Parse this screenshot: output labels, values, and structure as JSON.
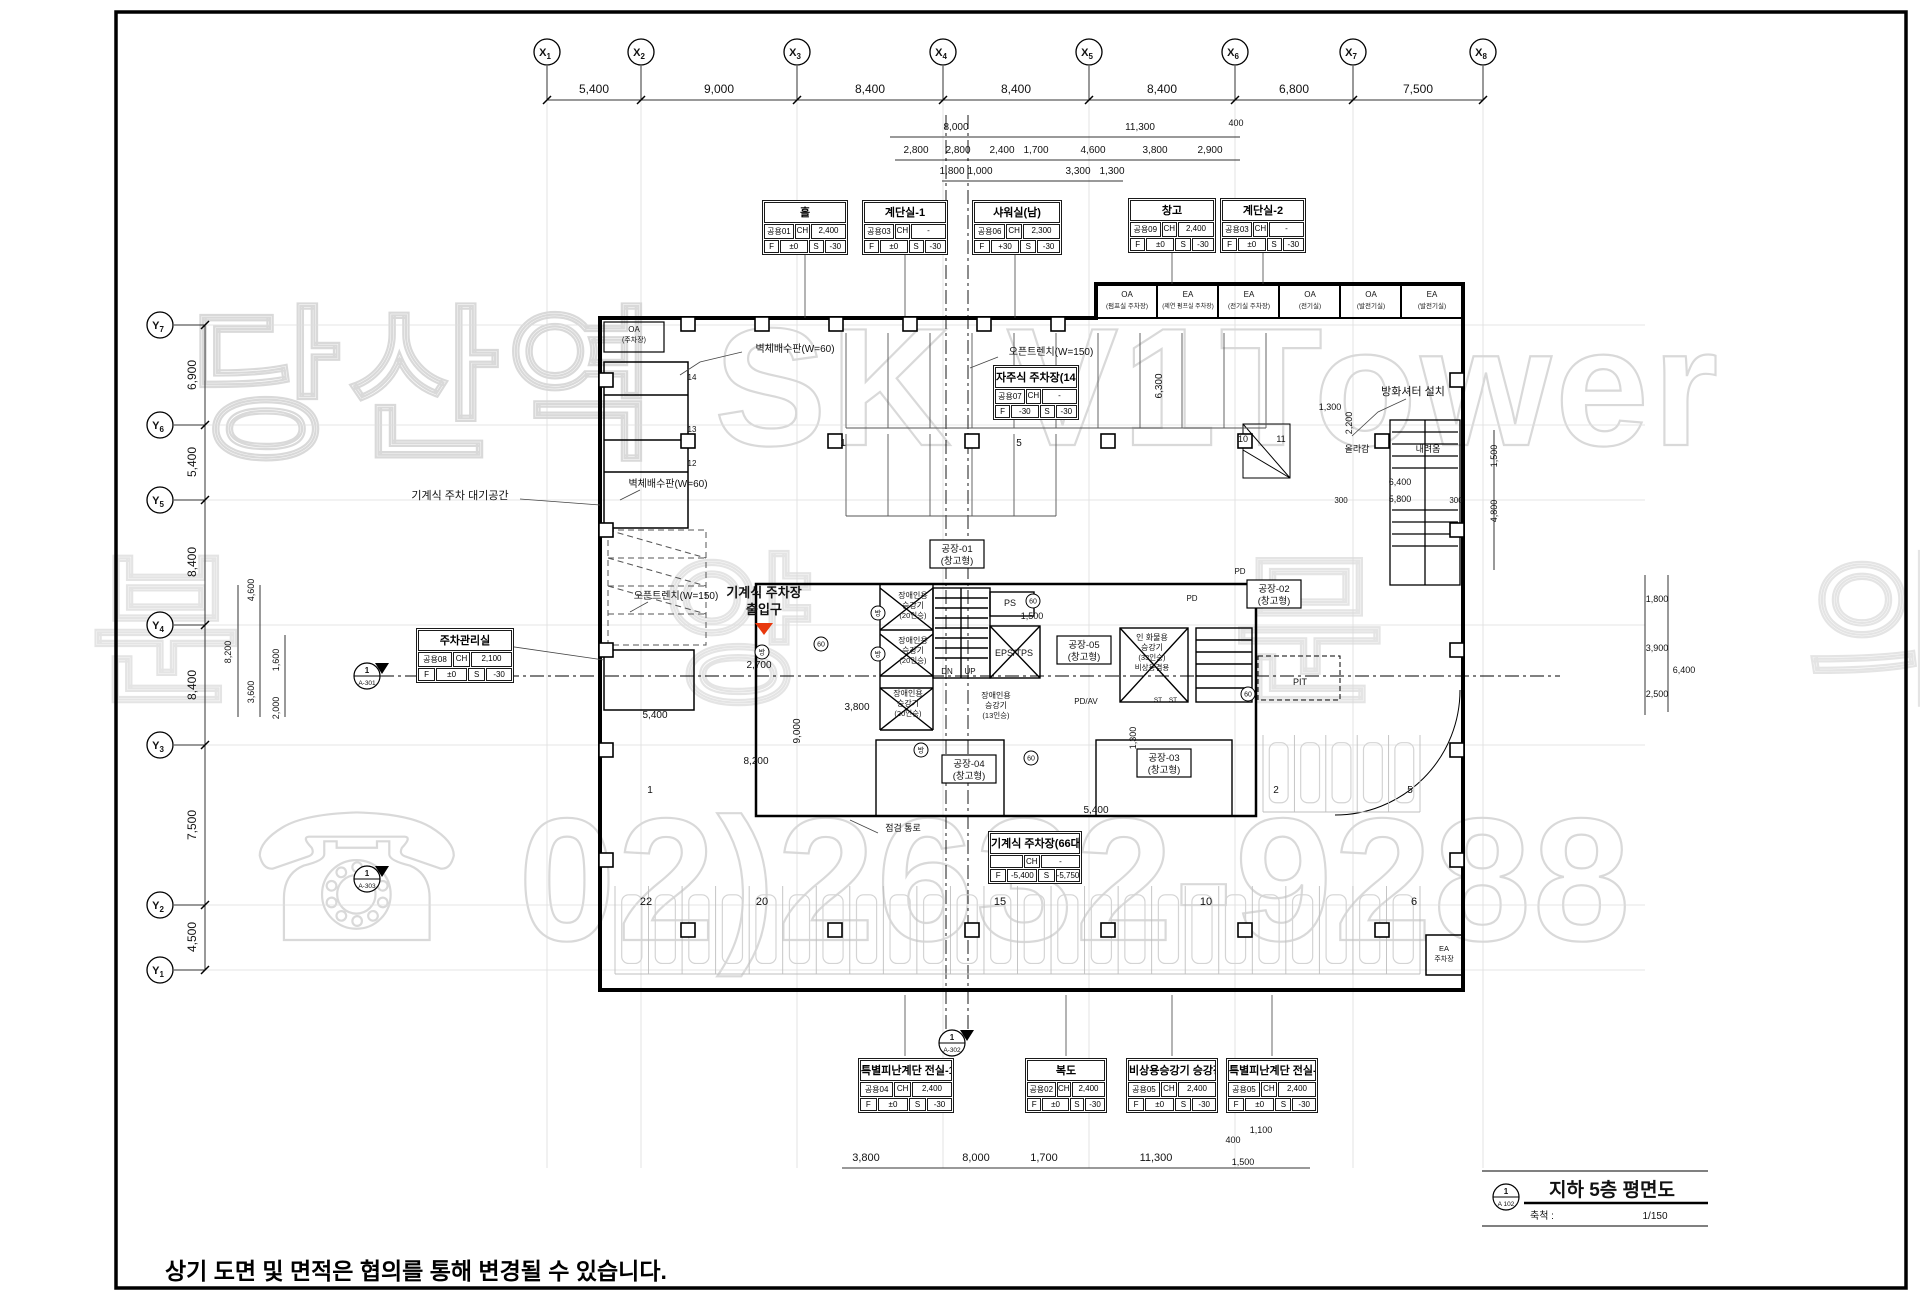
{
  "watermark": {
    "line1": "당산역 SK V1Tower",
    "line2": "분양문의",
    "line3": "☎ 02)2632-9288"
  },
  "footer_note": "상기 도면 및 면적은 협의를 통해 변경될 수 있습니다.",
  "title_block": {
    "num": "1",
    "sheet": "A 102",
    "title": "지하 5층 평면도",
    "scale_label": "축척 :",
    "scale": "1/150"
  },
  "red_label": {
    "line1": "기계식 주차장",
    "line2": "출입구"
  },
  "grid": {
    "x_markers": [
      {
        "t": "X1",
        "x": 547
      },
      {
        "t": "X2",
        "x": 641
      },
      {
        "t": "X3",
        "x": 797
      },
      {
        "t": "X4",
        "x": 943
      },
      {
        "t": "X5",
        "x": 1089
      },
      {
        "t": "X6",
        "x": 1235
      },
      {
        "t": "X7",
        "x": 1353
      },
      {
        "t": "X8",
        "x": 1483
      }
    ],
    "y_markers": [
      {
        "t": "Y7",
        "y": 325
      },
      {
        "t": "Y6",
        "y": 425
      },
      {
        "t": "Y5",
        "y": 500
      },
      {
        "t": "Y4",
        "y": 625
      },
      {
        "t": "Y3",
        "y": 745
      },
      {
        "t": "Y2",
        "y": 905
      },
      {
        "t": "Y1",
        "y": 970
      }
    ]
  },
  "room_tables": [
    {
      "x": 762,
      "y": 200,
      "w": 86,
      "label": "홀",
      "code": "공용01",
      "ch": "CH",
      "chv": "2,400",
      "f": "F",
      "fv": "±0",
      "s": "S",
      "sv": "-30"
    },
    {
      "x": 862,
      "y": 200,
      "w": 86,
      "label": "계단실-1",
      "code": "공용03",
      "ch": "CH",
      "chv": "-",
      "f": "F",
      "fv": "±0",
      "s": "S",
      "sv": "-30"
    },
    {
      "x": 972,
      "y": 200,
      "w": 90,
      "label": "샤워실(남)",
      "code": "공용06",
      "ch": "CH",
      "chv": "2,300",
      "f": "F",
      "fv": "+30",
      "s": "S",
      "sv": "-30"
    },
    {
      "x": 1128,
      "y": 198,
      "w": 88,
      "label": "창고",
      "code": "공용09",
      "ch": "CH",
      "chv": "2,400",
      "f": "F",
      "fv": "±0",
      "s": "S",
      "sv": "-30"
    },
    {
      "x": 1220,
      "y": 198,
      "w": 86,
      "label": "계단실-2",
      "code": "공용03",
      "ch": "CH",
      "chv": "-",
      "f": "F",
      "fv": "±0",
      "s": "S",
      "sv": "-30"
    },
    {
      "x": 993,
      "y": 365,
      "w": 86,
      "label": "자주식 주차장(14대)",
      "code": "공용07",
      "ch": "CH",
      "chv": "-",
      "f": "F",
      "fv": "-30",
      "s": "S",
      "sv": "-30"
    },
    {
      "x": 416,
      "y": 628,
      "w": 98,
      "label": "주차관리실",
      "code": "공용08",
      "ch": "CH",
      "chv": "2,100",
      "f": "F",
      "fv": "±0",
      "s": "S",
      "sv": "-30"
    },
    {
      "x": 988,
      "y": 831,
      "w": 94,
      "label": "기계식 주차장(66대)",
      "code": "",
      "ch": "CH",
      "chv": "-",
      "f": "F",
      "fv": "-5,400",
      "s": "S",
      "sv": "-5,750"
    },
    {
      "x": 858,
      "y": 1058,
      "w": 96,
      "label": "특별피난계단 전실-1",
      "code": "공용04",
      "ch": "CH",
      "chv": "2,400",
      "f": "F",
      "fv": "±0",
      "s": "S",
      "sv": "-30"
    },
    {
      "x": 1025,
      "y": 1058,
      "w": 82,
      "label": "복도",
      "code": "공용02",
      "ch": "CH",
      "chv": "2,400",
      "f": "F",
      "fv": "±0",
      "s": "S",
      "sv": "-30"
    },
    {
      "x": 1126,
      "y": 1058,
      "w": 92,
      "label": "비상용승강기 승강장",
      "code": "공용05",
      "ch": "CH",
      "chv": "2,400",
      "f": "F",
      "fv": "±0",
      "s": "S",
      "sv": "-30"
    },
    {
      "x": 1226,
      "y": 1058,
      "w": 92,
      "label": "특별피난계단 전실-2",
      "code": "공용05",
      "ch": "CH",
      "chv": "2,400",
      "f": "F",
      "fv": "±0",
      "s": "S",
      "sv": "-30"
    }
  ],
  "annotations": [
    {
      "t": "5,400",
      "x": 594,
      "y": 93,
      "s": 12
    },
    {
      "t": "9,000",
      "x": 719,
      "y": 93,
      "s": 12
    },
    {
      "t": "8,400",
      "x": 870,
      "y": 93,
      "s": 12
    },
    {
      "t": "8,400",
      "x": 1016,
      "y": 93,
      "s": 12
    },
    {
      "t": "8,400",
      "x": 1162,
      "y": 93,
      "s": 12
    },
    {
      "t": "6,800",
      "x": 1294,
      "y": 93,
      "s": 12
    },
    {
      "t": "7,500",
      "x": 1418,
      "y": 93,
      "s": 12
    },
    {
      "t": "8,000",
      "x": 956,
      "y": 130,
      "s": 10
    },
    {
      "t": "11,300",
      "x": 1140,
      "y": 130,
      "s": 10
    },
    {
      "t": "400",
      "x": 1236,
      "y": 126,
      "s": 9
    },
    {
      "t": "2,800",
      "x": 916,
      "y": 153,
      "s": 10
    },
    {
      "t": "2,800",
      "x": 958,
      "y": 153,
      "s": 10
    },
    {
      "t": "2,400",
      "x": 1002,
      "y": 153,
      "s": 10
    },
    {
      "t": "1,700",
      "x": 1036,
      "y": 153,
      "s": 10
    },
    {
      "t": "4,600",
      "x": 1093,
      "y": 153,
      "s": 10
    },
    {
      "t": "3,800",
      "x": 1155,
      "y": 153,
      "s": 10
    },
    {
      "t": "2,900",
      "x": 1210,
      "y": 153,
      "s": 10
    },
    {
      "t": "1,800",
      "x": 952,
      "y": 174,
      "s": 10
    },
    {
      "t": "1,000",
      "x": 980,
      "y": 174,
      "s": 10
    },
    {
      "t": "3,300",
      "x": 1078,
      "y": 174,
      "s": 10
    },
    {
      "t": "1,300",
      "x": 1112,
      "y": 174,
      "s": 10
    },
    {
      "t": "6,900",
      "x": 196,
      "y": 375,
      "s": 12,
      "r": 1
    },
    {
      "t": "5,400",
      "x": 196,
      "y": 462,
      "s": 12,
      "r": 1
    },
    {
      "t": "8,400",
      "x": 196,
      "y": 562,
      "s": 12,
      "r": 1
    },
    {
      "t": "8,400",
      "x": 196,
      "y": 685,
      "s": 12,
      "r": 1
    },
    {
      "t": "7,500",
      "x": 196,
      "y": 825,
      "s": 12,
      "r": 1
    },
    {
      "t": "4,500",
      "x": 196,
      "y": 937,
      "s": 12,
      "r": 1
    },
    {
      "t": "8,200",
      "x": 231,
      "y": 652,
      "s": 9,
      "r": 1
    },
    {
      "t": "4,600",
      "x": 254,
      "y": 590,
      "s": 9,
      "r": 1
    },
    {
      "t": "3,600",
      "x": 254,
      "y": 692,
      "s": 9,
      "r": 1
    },
    {
      "t": "1,600",
      "x": 279,
      "y": 660,
      "s": 9,
      "r": 1
    },
    {
      "t": "2,000",
      "x": 279,
      "y": 708,
      "s": 9,
      "r": 1
    },
    {
      "t": "1,800",
      "x": 1657,
      "y": 602,
      "s": 9
    },
    {
      "t": "3,900",
      "x": 1657,
      "y": 651,
      "s": 9
    },
    {
      "t": "6,400",
      "x": 1684,
      "y": 673,
      "s": 9
    },
    {
      "t": "2,500",
      "x": 1657,
      "y": 697,
      "s": 9
    },
    {
      "t": "1,500",
      "x": 1497,
      "y": 456,
      "s": 9,
      "r": 1
    },
    {
      "t": "4,800",
      "x": 1497,
      "y": 511,
      "s": 9,
      "r": 1
    },
    {
      "t": "1,300",
      "x": 1330,
      "y": 410,
      "s": 9
    },
    {
      "t": "2,200",
      "x": 1352,
      "y": 423,
      "s": 9,
      "r": 1
    },
    {
      "t": "올라감",
      "x": 1357,
      "y": 452,
      "s": 9
    },
    {
      "t": "내려옴",
      "x": 1428,
      "y": 452,
      "s": 9
    },
    {
      "t": "6,400",
      "x": 1400,
      "y": 485,
      "s": 9
    },
    {
      "t": "5,800",
      "x": 1400,
      "y": 502,
      "s": 9
    },
    {
      "t": "300",
      "x": 1341,
      "y": 503,
      "s": 8
    },
    {
      "t": "300",
      "x": 1456,
      "y": 503,
      "s": 8
    },
    {
      "t": "6,300",
      "x": 1162,
      "y": 386,
      "s": 10,
      "r": 1
    },
    {
      "t": "2,700",
      "x": 759,
      "y": 668,
      "s": 10
    },
    {
      "t": "3,800",
      "x": 857,
      "y": 710,
      "s": 10
    },
    {
      "t": "5,400",
      "x": 655,
      "y": 718,
      "s": 10
    },
    {
      "t": "8,200",
      "x": 756,
      "y": 764,
      "s": 10
    },
    {
      "t": "9,000",
      "x": 800,
      "y": 731,
      "s": 10,
      "r": 1
    },
    {
      "t": "5,400",
      "x": 1096,
      "y": 813,
      "s": 10
    },
    {
      "t": "1,300",
      "x": 1136,
      "y": 738,
      "s": 9,
      "r": 1
    },
    {
      "t": "1,500",
      "x": 1032,
      "y": 619,
      "s": 9
    },
    {
      "t": "3,800",
      "x": 866,
      "y": 1161,
      "s": 11
    },
    {
      "t": "8,000",
      "x": 976,
      "y": 1161,
      "s": 11
    },
    {
      "t": "1,700",
      "x": 1044,
      "y": 1161,
      "s": 11
    },
    {
      "t": "11,300",
      "x": 1156,
      "y": 1161,
      "s": 11
    },
    {
      "t": "400",
      "x": 1233,
      "y": 1143,
      "s": 9
    },
    {
      "t": "1,100",
      "x": 1261,
      "y": 1133,
      "s": 9
    },
    {
      "t": "1,500",
      "x": 1243,
      "y": 1165,
      "s": 9
    },
    {
      "t": "기계식 주차 대기공간",
      "x": 460,
      "y": 499,
      "s": 11,
      "n": "waiting-area-label"
    },
    {
      "t": "벽체배수판(W=60)",
      "x": 795,
      "y": 352,
      "s": 10,
      "n": "wall-drain-label"
    },
    {
      "t": "벽체배수판(W=60)",
      "x": 668,
      "y": 487,
      "s": 10,
      "n": "wall-drain-label"
    },
    {
      "t": "오픈트렌치(W=150)",
      "x": 1051,
      "y": 355,
      "s": 10,
      "n": "open-trench-label"
    },
    {
      "t": "오픈트렌치(W=150)",
      "x": 676,
      "y": 599,
      "s": 10,
      "n": "open-trench-label"
    },
    {
      "t": "방화셔터 설치",
      "x": 1413,
      "y": 395,
      "s": 11,
      "n": "fire-shutter-label"
    },
    {
      "t": "점검 통로",
      "x": 903,
      "y": 831,
      "s": 9,
      "n": "inspection-path-label"
    },
    {
      "t": "OA",
      "x": 634,
      "y": 332,
      "s": 8
    },
    {
      "t": "(주차장)",
      "x": 634,
      "y": 342,
      "s": 7
    },
    {
      "t": "OA",
      "x": 1127,
      "y": 297,
      "s": 8
    },
    {
      "t": "(펌프실 주차장)",
      "x": 1127,
      "y": 308,
      "s": 6.5
    },
    {
      "t": "EA",
      "x": 1188,
      "y": 297,
      "s": 8
    },
    {
      "t": "(제연 펌프실 주차장)",
      "x": 1188,
      "y": 308,
      "s": 6
    },
    {
      "t": "EA",
      "x": 1249,
      "y": 297,
      "s": 8
    },
    {
      "t": "(전기실 주차장)",
      "x": 1249,
      "y": 308,
      "s": 6.5
    },
    {
      "t": "OA",
      "x": 1310,
      "y": 297,
      "s": 8
    },
    {
      "t": "(전기실)",
      "x": 1310,
      "y": 308,
      "s": 6.5
    },
    {
      "t": "OA",
      "x": 1371,
      "y": 297,
      "s": 8
    },
    {
      "t": "(발전기실)",
      "x": 1371,
      "y": 308,
      "s": 6.5
    },
    {
      "t": "EA",
      "x": 1432,
      "y": 297,
      "s": 8
    },
    {
      "t": "(발전기실)",
      "x": 1432,
      "y": 308,
      "s": 6.5
    },
    {
      "t": "EA",
      "x": 1444,
      "y": 951,
      "s": 7.5
    },
    {
      "t": "주차장",
      "x": 1444,
      "y": 961,
      "s": 7
    },
    {
      "t": "장애인용",
      "x": 913,
      "y": 598,
      "s": 8
    },
    {
      "t": "승강기",
      "x": 913,
      "y": 608,
      "s": 8
    },
    {
      "t": "(20인승)",
      "x": 913,
      "y": 618,
      "s": 7.5
    },
    {
      "t": "장애인용",
      "x": 913,
      "y": 643,
      "s": 8
    },
    {
      "t": "승강기",
      "x": 913,
      "y": 653,
      "s": 8
    },
    {
      "t": "(20인승)",
      "x": 913,
      "y": 663,
      "s": 7.5
    },
    {
      "t": "장애인용",
      "x": 908,
      "y": 696,
      "s": 8
    },
    {
      "t": "승강기",
      "x": 908,
      "y": 706,
      "s": 8
    },
    {
      "t": "(20인승)",
      "x": 908,
      "y": 716,
      "s": 7.5
    },
    {
      "t": "장애인용",
      "x": 996,
      "y": 698,
      "s": 8
    },
    {
      "t": "승강기",
      "x": 996,
      "y": 708,
      "s": 8
    },
    {
      "t": "(13인승)",
      "x": 996,
      "y": 718,
      "s": 7.5
    },
    {
      "t": "PS",
      "x": 1010,
      "y": 606,
      "s": 9
    },
    {
      "t": "EPS/TPS",
      "x": 1014,
      "y": 656,
      "s": 9
    },
    {
      "t": "DN",
      "x": 947,
      "y": 674,
      "s": 8
    },
    {
      "t": "UP",
      "x": 970,
      "y": 674,
      "s": 8
    },
    {
      "t": "PD",
      "x": 1192,
      "y": 601,
      "s": 8
    },
    {
      "t": "PD",
      "x": 1248,
      "y": 695,
      "s": 8
    },
    {
      "t": "PD",
      "x": 1240,
      "y": 574,
      "s": 8
    },
    {
      "t": "PD/AV",
      "x": 1086,
      "y": 704,
      "s": 8
    },
    {
      "t": "PIT",
      "x": 1300,
      "y": 685,
      "s": 9
    },
    {
      "t": "ST",
      "x": 1158,
      "y": 702,
      "s": 6.5
    },
    {
      "t": "ST",
      "x": 1173,
      "y": 702,
      "s": 6.5
    },
    {
      "t": "인 화물용",
      "x": 1152,
      "y": 640,
      "s": 8
    },
    {
      "t": "승강기",
      "x": 1152,
      "y": 650,
      "s": 8
    },
    {
      "t": "(33인승)",
      "x": 1152,
      "y": 660,
      "s": 7.5
    },
    {
      "t": "비상용겸용",
      "x": 1152,
      "y": 670,
      "s": 7.5
    },
    {
      "t": "공장-01",
      "x": 957,
      "y": 552,
      "s": 9.5
    },
    {
      "t": "(창고형)",
      "x": 957,
      "y": 564,
      "s": 9.5
    },
    {
      "t": "공장-02",
      "x": 1274,
      "y": 592,
      "s": 9.5
    },
    {
      "t": "(창고형)",
      "x": 1274,
      "y": 604,
      "s": 9.5
    },
    {
      "t": "공장-05",
      "x": 1084,
      "y": 648,
      "s": 9.5
    },
    {
      "t": "(창고형)",
      "x": 1084,
      "y": 660,
      "s": 9.5
    },
    {
      "t": "공장-03",
      "x": 1164,
      "y": 761,
      "s": 9.5
    },
    {
      "t": "(창고형)",
      "x": 1164,
      "y": 773,
      "s": 9.5
    },
    {
      "t": "공장-04",
      "x": 969,
      "y": 767,
      "s": 9.5
    },
    {
      "t": "(창고형)",
      "x": 969,
      "y": 779,
      "s": 9.5
    },
    {
      "t": "1",
      "x": 843,
      "y": 446,
      "s": 10
    },
    {
      "t": "5",
      "x": 1019,
      "y": 446,
      "s": 10
    },
    {
      "t": "10",
      "x": 1243,
      "y": 442,
      "s": 9
    },
    {
      "t": "11",
      "x": 1281,
      "y": 442,
      "s": 9
    },
    {
      "t": "22",
      "x": 646,
      "y": 905,
      "s": 11
    },
    {
      "t": "20",
      "x": 762,
      "y": 905,
      "s": 11
    },
    {
      "t": "15",
      "x": 1000,
      "y": 905,
      "s": 11
    },
    {
      "t": "10",
      "x": 1206,
      "y": 905,
      "s": 11
    },
    {
      "t": "6",
      "x": 1414,
      "y": 905,
      "s": 11
    },
    {
      "t": "1",
      "x": 650,
      "y": 793,
      "s": 10
    },
    {
      "t": "2",
      "x": 1276,
      "y": 793,
      "s": 10
    },
    {
      "t": "5",
      "x": 1410,
      "y": 793,
      "s": 10
    },
    {
      "t": "14",
      "x": 692,
      "y": 380,
      "s": 8
    },
    {
      "t": "13",
      "x": 692,
      "y": 432,
      "s": 8
    },
    {
      "t": "12",
      "x": 692,
      "y": 466,
      "s": 8
    }
  ],
  "circle_marks": [
    {
      "t": "방",
      "x": 878,
      "y": 613
    },
    {
      "t": "방",
      "x": 878,
      "y": 654
    },
    {
      "t": "방",
      "x": 762,
      "y": 652
    },
    {
      "t": "방",
      "x": 921,
      "y": 750
    },
    {
      "t": "60",
      "x": 1033,
      "y": 601
    },
    {
      "t": "60",
      "x": 821,
      "y": 644
    },
    {
      "t": "60",
      "x": 1248,
      "y": 694
    },
    {
      "t": "60",
      "x": 1031,
      "y": 758
    }
  ],
  "section_markers": [
    {
      "x": 367,
      "y": 676,
      "num": "1",
      "sheet": "A-301"
    },
    {
      "x": 367,
      "y": 879,
      "num": "1",
      "sheet": "A-303"
    },
    {
      "x": 952,
      "y": 1043,
      "num": "1",
      "sheet": "A-302"
    }
  ],
  "columns": [
    [
      688,
      324
    ],
    [
      762,
      324
    ],
    [
      836,
      324
    ],
    [
      910,
      324
    ],
    [
      984,
      324
    ],
    [
      1058,
      324
    ],
    [
      688,
      441
    ],
    [
      835,
      441
    ],
    [
      972,
      441
    ],
    [
      1108,
      441
    ],
    [
      1245,
      441
    ],
    [
      1382,
      441
    ],
    [
      688,
      930
    ],
    [
      835,
      930
    ],
    [
      972,
      930
    ],
    [
      1108,
      930
    ],
    [
      1245,
      930
    ],
    [
      1382,
      930
    ],
    [
      606,
      380
    ],
    [
      606,
      530
    ],
    [
      606,
      650
    ],
    [
      606,
      750
    ],
    [
      606,
      860
    ],
    [
      1457,
      380
    ],
    [
      1457,
      530
    ],
    [
      1457,
      650
    ],
    [
      1457,
      750
    ],
    [
      1457,
      860
    ]
  ],
  "parking_rows": [
    {
      "x0": 846,
      "x1": 1266,
      "y0": 333,
      "y1": 428,
      "n": 10,
      "dark": 1
    },
    {
      "x0": 846,
      "x1": 1056,
      "y0": 434,
      "y1": 516,
      "n": 5,
      "dark": 1
    },
    {
      "x0": 615,
      "x1": 1420,
      "y0": 886,
      "y1": 974,
      "n": 24,
      "cars": 1
    },
    {
      "x0": 1263,
      "x1": 1420,
      "y0": 735,
      "y1": 812,
      "n": 5,
      "cars": 1
    }
  ]
}
